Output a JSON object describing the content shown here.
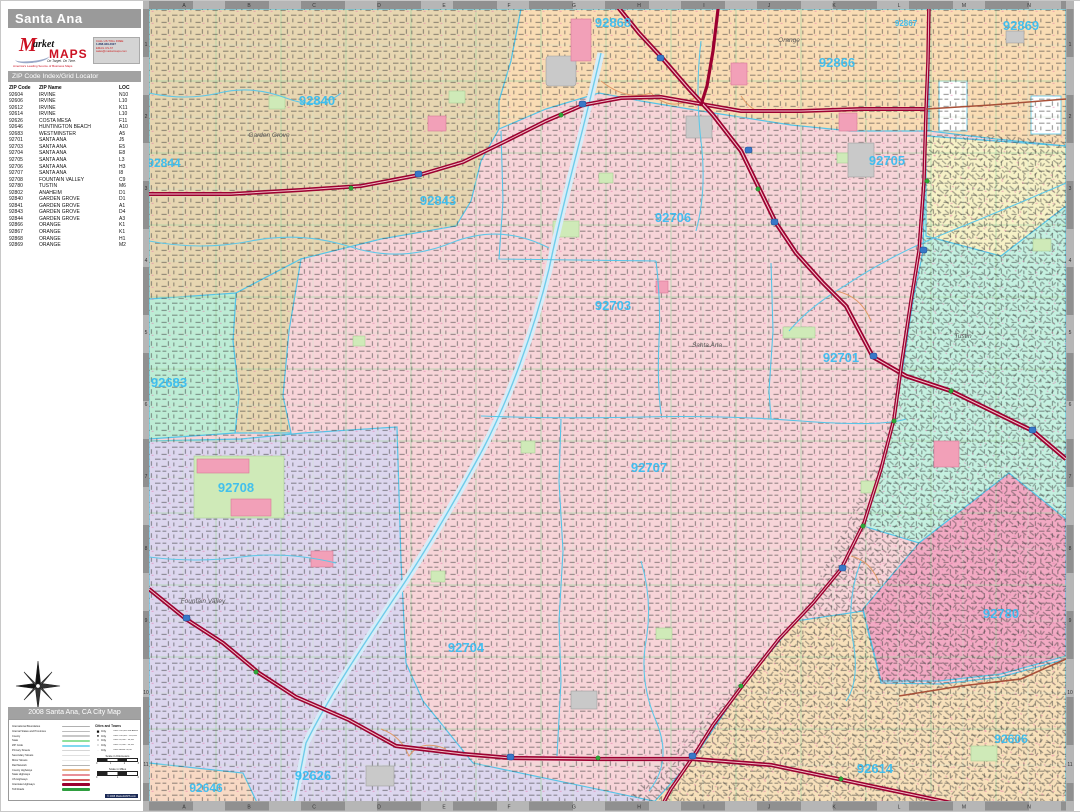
{
  "poster": {
    "title": "Santa Ana"
  },
  "logo": {
    "brand_m": "M",
    "brand_rest": "arket",
    "brand_maps": "MAPS",
    "tagline": "On Target. On Time.",
    "subtitle": "America's Leading Source of Business Maps",
    "contact_lines": [
      "CALL US TOLL FREE",
      "1-888-929-4627",
      "EMAIL US AT",
      "sales@marketmaps.com"
    ]
  },
  "index": {
    "header": "ZIP Code Index/Grid Locator",
    "columns": [
      "ZIP Code",
      "ZIP Name",
      "LOC"
    ],
    "rows": [
      [
        "92604",
        "IRVINE",
        "N10"
      ],
      [
        "92606",
        "IRVINE",
        "L10"
      ],
      [
        "92612",
        "IRVINE",
        "K11"
      ],
      [
        "92614",
        "IRVINE",
        "L10"
      ],
      [
        "92626",
        "COSTA MESA",
        "F11"
      ],
      [
        "92646",
        "HUNTINGTON BEACH",
        "A10"
      ],
      [
        "92683",
        "WESTMINSTER",
        "A5"
      ],
      [
        "92701",
        "SANTA ANA",
        "J5"
      ],
      [
        "92703",
        "SANTA ANA",
        "E5"
      ],
      [
        "92704",
        "SANTA ANA",
        "E8"
      ],
      [
        "92705",
        "SANTA ANA",
        "L3"
      ],
      [
        "92706",
        "SANTA ANA",
        "H3"
      ],
      [
        "92707",
        "SANTA ANA",
        "I8"
      ],
      [
        "92708",
        "FOUNTAIN VALLEY",
        "C9"
      ],
      [
        "92780",
        "TUSTIN",
        "M6"
      ],
      [
        "92802",
        "ANAHEIM",
        "D1"
      ],
      [
        "92840",
        "GARDEN GROVE",
        "D1"
      ],
      [
        "92841",
        "GARDEN GROVE",
        "A1"
      ],
      [
        "92843",
        "GARDEN GROVE",
        "D4"
      ],
      [
        "92844",
        "GARDEN GROVE",
        "A3"
      ],
      [
        "92866",
        "ORANGE",
        "K1"
      ],
      [
        "92867",
        "ORANGE",
        "K1"
      ],
      [
        "92868",
        "ORANGE",
        "H1"
      ],
      [
        "92869",
        "ORANGE",
        "M2"
      ]
    ]
  },
  "legend": {
    "header": "2008 Santa Ana, CA City Map",
    "line_items": [
      {
        "label": "International Boundaries",
        "color": "#b0b0b0",
        "h": 1.6
      },
      {
        "label": "Internal States and Provinces",
        "color": "#bcbcbc",
        "h": 1.4
      },
      {
        "label": "County",
        "color": "#c8c8c8",
        "h": 1.4
      },
      {
        "label": "State",
        "color": "#8fe09a",
        "h": 1.8
      },
      {
        "label": "ZIP Code",
        "color": "#7fd8f0",
        "h": 1.8
      },
      {
        "label": "Primary Streets",
        "color": "#d6d6d6",
        "h": 1.4
      },
      {
        "label": "Secondary Streets",
        "color": "#e0e0e0",
        "h": 1.2
      },
      {
        "label": "Minor Streets",
        "color": "#eaeaea",
        "h": 1.2
      },
      {
        "label": "Rail Network",
        "color": "#b4b4b4",
        "h": 1.2
      },
      {
        "label": "County Highways",
        "color": "#e8b88a",
        "h": 1.8
      },
      {
        "label": "State Highways",
        "color": "#e89098",
        "h": 1.8
      },
      {
        "label": "US Highways",
        "color": "#d86060",
        "h": 1.8
      },
      {
        "label": "Interstate Highways",
        "color": "#9c0030",
        "h": 2.4
      },
      {
        "label": "Toll Roads",
        "color": "#2f9e3f",
        "h": 2.4
      }
    ],
    "cities_header": "Cities and Towns",
    "city_classes": [
      {
        "sym": "■",
        "size": 4.6,
        "label": "City",
        "range": "Cities 250,000 and Above"
      },
      {
        "sym": "●",
        "size": 4.0,
        "label": "City",
        "range": "Cities 100,000 - 249,999"
      },
      {
        "sym": "•",
        "size": 3.6,
        "label": "City",
        "range": "Cities 50,000 - 99,999"
      },
      {
        "sym": "○",
        "size": 3.2,
        "label": "City",
        "range": "Cities 25,000 - 49,999"
      },
      {
        "sym": "·",
        "size": 3.0,
        "label": "City",
        "range": "Cities Below 25,000"
      }
    ],
    "scale_km_label": "Scale in Kilometers",
    "scale_km_ticks": [
      "0",
      "1",
      "2",
      "3"
    ],
    "scale_mi_label": "Scale in Miles",
    "scale_mi_ticks": [
      "0",
      "1",
      "2"
    ],
    "copyright": "© 2008 MarketMAPS.com"
  },
  "map": {
    "grid_columns": [
      "A",
      "B",
      "C",
      "D",
      "E",
      "F",
      "G",
      "H",
      "I",
      "J",
      "K",
      "L",
      "M",
      "N"
    ],
    "grid_rows": [
      "1",
      "2",
      "3",
      "4",
      "5",
      "6",
      "7",
      "8",
      "9",
      "10",
      "11"
    ],
    "zip_labels": [
      {
        "text": "92840",
        "x": 316,
        "y": 104,
        "size": 13
      },
      {
        "text": "92844",
        "x": 163,
        "y": 166,
        "size": 12
      },
      {
        "text": "92843",
        "x": 437,
        "y": 204,
        "size": 13
      },
      {
        "text": "92868",
        "x": 612,
        "y": 26,
        "size": 13
      },
      {
        "text": "92866",
        "x": 836,
        "y": 66,
        "size": 13
      },
      {
        "text": "92867",
        "x": 905,
        "y": 25,
        "size": 8
      },
      {
        "text": "92869",
        "x": 1020,
        "y": 29,
        "size": 13
      },
      {
        "text": "92705",
        "x": 886,
        "y": 164,
        "size": 13
      },
      {
        "text": "92706",
        "x": 672,
        "y": 221,
        "size": 13
      },
      {
        "text": "92703",
        "x": 612,
        "y": 309,
        "size": 13
      },
      {
        "text": "92701",
        "x": 840,
        "y": 361,
        "size": 13
      },
      {
        "text": "92683",
        "x": 168,
        "y": 386,
        "size": 13
      },
      {
        "text": "92708",
        "x": 235,
        "y": 491,
        "size": 13
      },
      {
        "text": "92707",
        "x": 648,
        "y": 471,
        "size": 13
      },
      {
        "text": "92704",
        "x": 465,
        "y": 651,
        "size": 13
      },
      {
        "text": "92780",
        "x": 1000,
        "y": 617,
        "size": 13
      },
      {
        "text": "92626",
        "x": 312,
        "y": 779,
        "size": 13
      },
      {
        "text": "92646",
        "x": 205,
        "y": 791,
        "size": 12
      },
      {
        "text": "92606",
        "x": 1010,
        "y": 742,
        "size": 12
      },
      {
        "text": "92614",
        "x": 874,
        "y": 772,
        "size": 13
      }
    ],
    "city_labels": [
      {
        "text": "Garden Grove",
        "x": 268,
        "y": 136
      },
      {
        "text": "Orange",
        "x": 788,
        "y": 41
      },
      {
        "text": "Santa Ana",
        "x": 706,
        "y": 346
      },
      {
        "text": "Tustin",
        "x": 962,
        "y": 337
      },
      {
        "text": "Fountain Valley",
        "x": 202,
        "y": 602
      }
    ],
    "colors": {
      "santa_ana_pink": "#f7d4d8",
      "garden_grove_tan": "#e7d6b1",
      "orange_peach": "#f9dcb4",
      "pale_yellow": "#f6f1c6",
      "westminster_mint": "#bdecd5",
      "tustin_aqua": "#c4f0e0",
      "fountain_valley_lavender": "#dcd6ee",
      "tustin_rose": "#f2a9c3",
      "irvine_sand": "#f7e0ba",
      "huntington_corner": "#f8d9c4",
      "freeway_red": "#9c0030",
      "zip_label_cyan": "#35bdf2",
      "water_cyan": "#5fc8e8",
      "grid_green": "#a5d6a5"
    }
  }
}
